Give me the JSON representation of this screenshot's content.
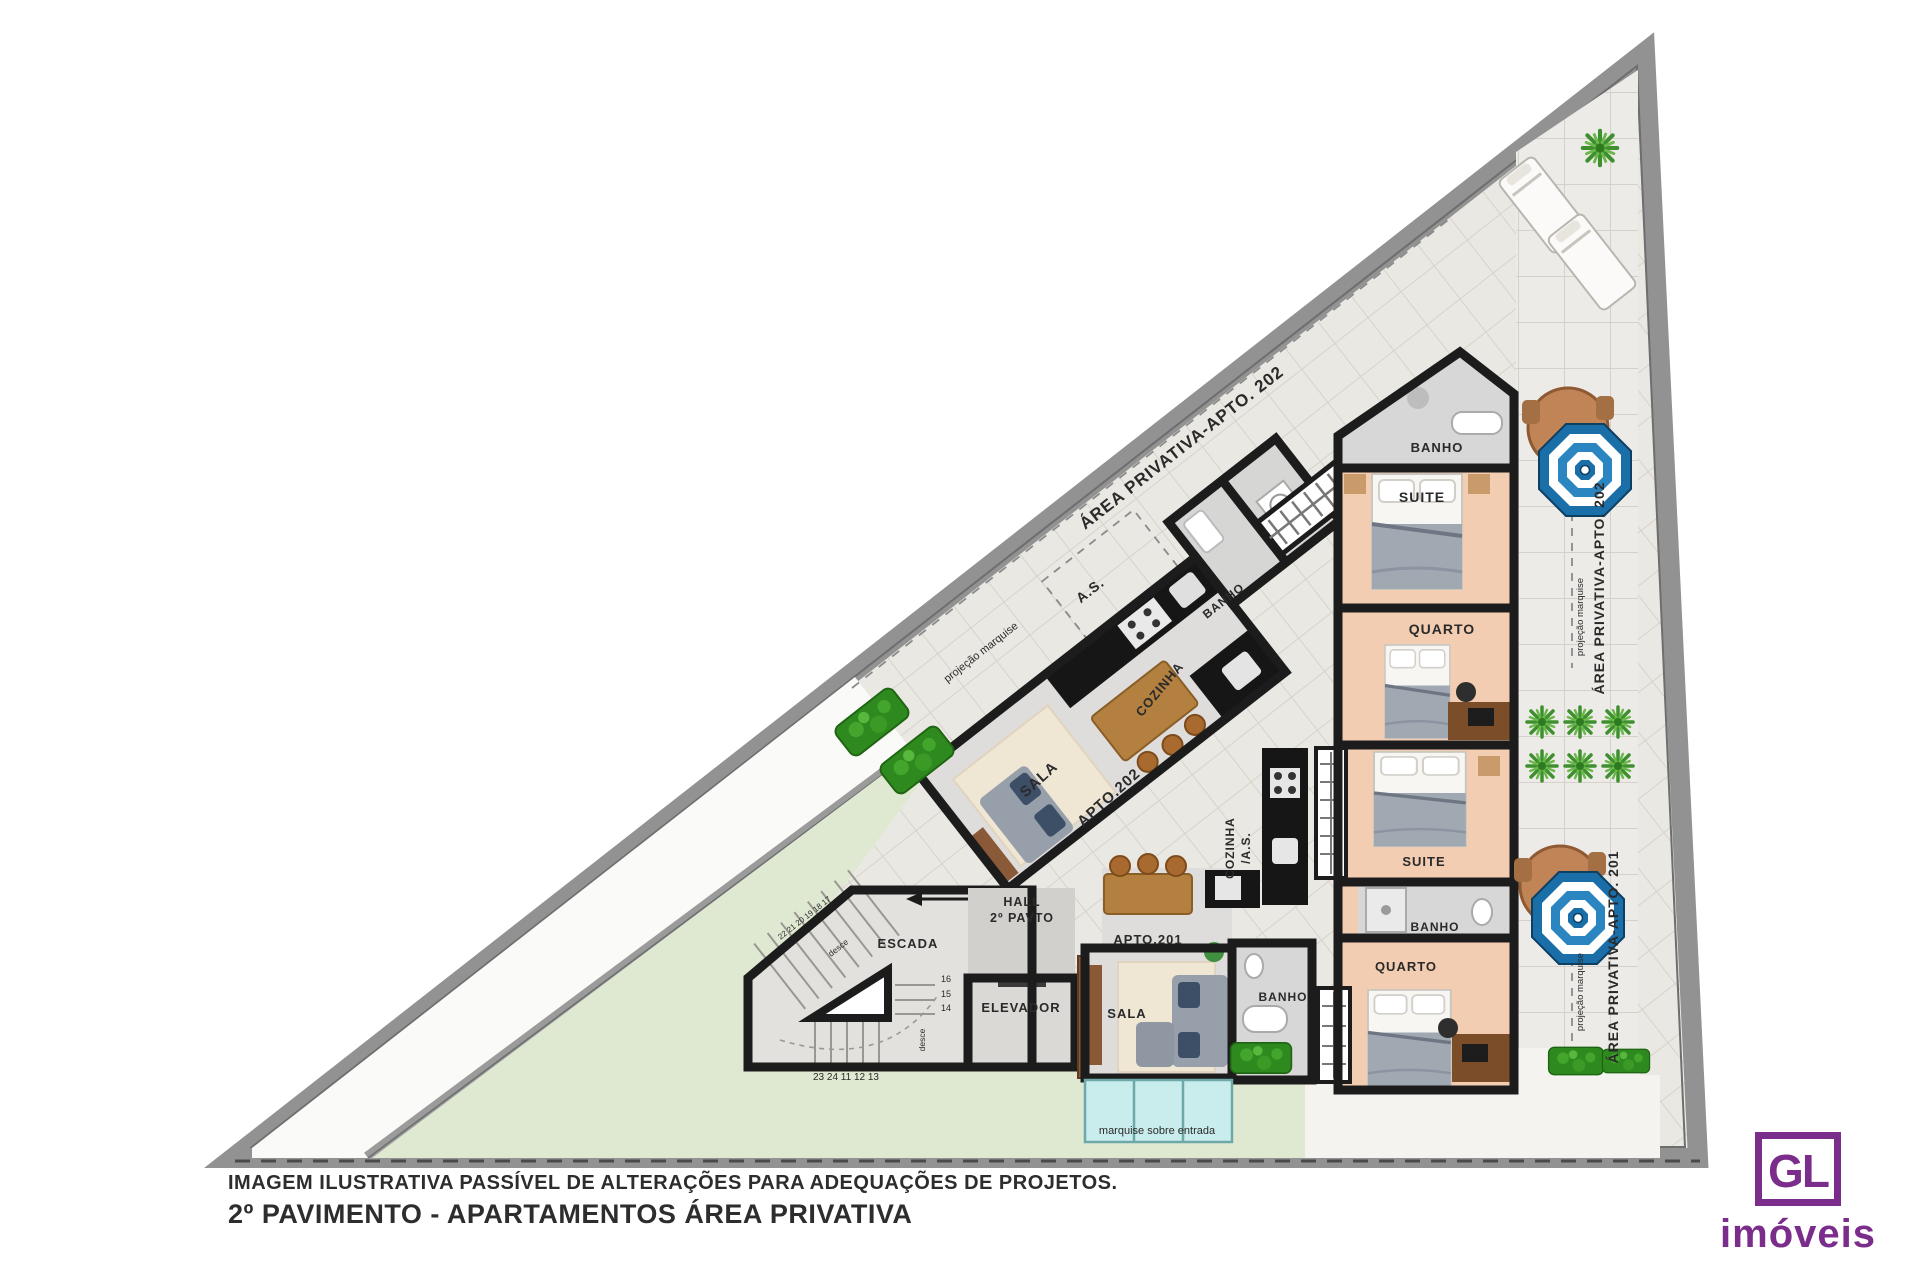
{
  "plan": {
    "apt202": {
      "area_diagonal": "ÁREA PRIVATIVA-APTO. 202",
      "as": "A.S.",
      "banho_top": "BANHO",
      "suite": "SUITE",
      "quarto": "QUARTO",
      "banho_mid": "BANHO",
      "cozinha": "COZINHA",
      "sala": "SALA",
      "apto": "APTO.202",
      "area_vertical": "ÁREA PRIVATIVA-APTO. 202"
    },
    "apt201": {
      "apto": "APTO.201",
      "sala": "SALA",
      "banho_mid": "BANHO",
      "cozinha_line1": "COZINHA",
      "cozinha_line2": "/A.S.",
      "quarto": "QUARTO",
      "suite": "SUITE",
      "banho_suite": "BANHO",
      "area_vertical": "ÁREA PRIVATIVA-APTO. 201"
    },
    "common": {
      "hall_line1": "HALL",
      "hall_line2": "2º PAVTO",
      "escada": "ESCADA",
      "elevador": "ELEVADOR",
      "desce": "desce",
      "stairs_bottom": "23 24 11 12 13",
      "stairs_diag": "22 21 20 19 18 17",
      "stairs_side": [
        "16",
        "15",
        "14"
      ],
      "projecao_marquise": "projeção marquise",
      "marquise_entry": "marquise sobre entrada"
    }
  },
  "footer": {
    "disclaimer": "IMAGEM ILUSTRATIVA PASSÍVEL DE ALTERAÇÕES PARA ADEQUAÇÕES DE PROJETOS.",
    "title": "2º PAVIMENTO - APARTAMENTOS ÁREA PRIVATIVA"
  },
  "logo": {
    "monogram": "GL",
    "name": "imóveis"
  },
  "colors": {
    "brand_purple": "#7b2d8b",
    "wall_black": "#1c1c1c",
    "parcel_wall_gray": "#929292",
    "tile": "#edebe7",
    "bedroom_peach": "#f2cdb2",
    "wet_area_gray": "#d7d7d7",
    "counter_black": "#161616",
    "lawn_green": "#dfe9d2",
    "hedge_green": "#2e8a1f",
    "umbrella_blue": "#1a6fa8",
    "marquise_cyan": "#c9eded",
    "wood_brown": "#8a5a38"
  }
}
